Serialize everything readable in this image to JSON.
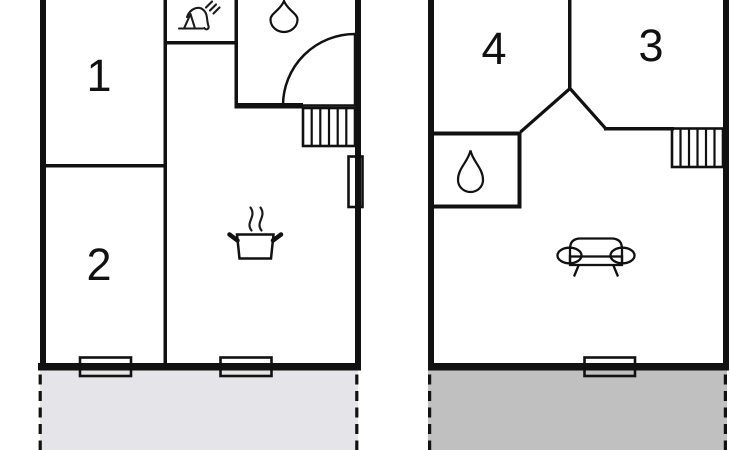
{
  "rooms": {
    "room1": "1",
    "room2": "2",
    "room3": "3",
    "room4": "4"
  },
  "colors": {
    "wall": "#111111",
    "water": "#b3edf4",
    "front_terrace": "#e5e5e9",
    "upper_terrace": "#c0c0c0",
    "steam": "#9b9b9b"
  },
  "icons": {
    "tap": "tap-icon",
    "water_drop": "water-drop-icon",
    "shower": "corner-shower-quarter-circle",
    "cooking_pot": "cooking-pot-steam-icon",
    "sofa": "sofa-icon",
    "stairs": "stairs-treads",
    "window": "window-opening"
  }
}
